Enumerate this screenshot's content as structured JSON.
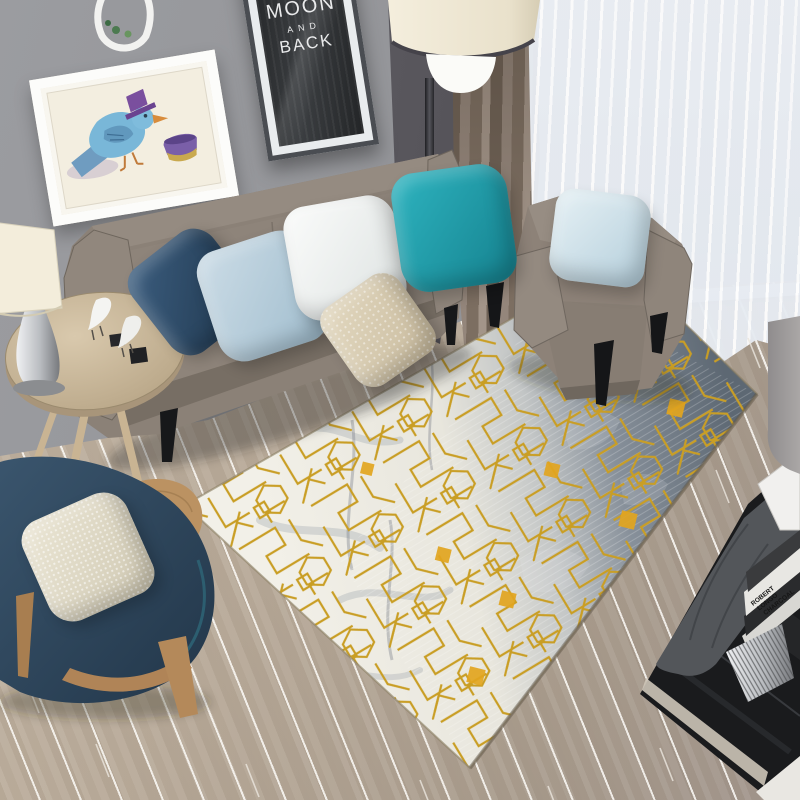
{
  "scene": {
    "title": "Modern living room with gold geometric rug",
    "poster": {
      "clipped_word": "YOU",
      "line1": "TO THE",
      "line2": "MOON",
      "line3": "AND",
      "line4": "BACK"
    },
    "book": {
      "words": [
        "ROBERT",
        "LONGO",
        "CHARCOAL"
      ]
    },
    "palette": {
      "wall": "#97989c",
      "sofa": "#8b8177",
      "teal_pillow": "#1f9fac",
      "navy_pillow": "#2d4a68",
      "light_blue_pillow": "#bdd3e0",
      "white_pillow": "#f4f5f4",
      "beige_pillow": "#d9cdb2",
      "rug_gold": "#c99e25",
      "rug_light": "#efede5",
      "rug_dark": "#5d6873",
      "floor_wood": "#b4a795",
      "curtain_brown": "#8b7d6f",
      "lounge_chair_navy": "#2d4257",
      "wood_legs": "#b4895a"
    }
  }
}
